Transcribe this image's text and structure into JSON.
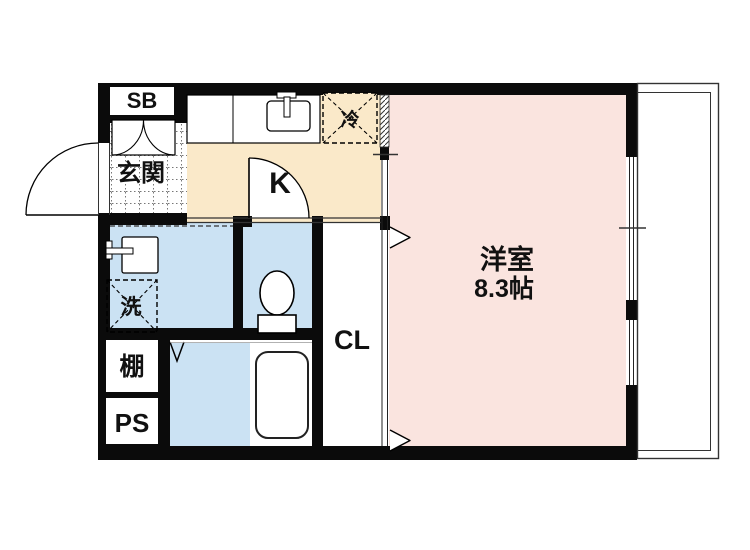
{
  "plan": {
    "labels": {
      "shoe_box": "SB",
      "entrance": "玄関",
      "kitchen": "K",
      "refrigerator": "冷",
      "washer": "洗",
      "shelf": "棚",
      "pipe_space": "PS",
      "closet": "CL",
      "room_name": "洋室",
      "room_size": "8.3帖"
    },
    "colors": {
      "wall": "#0b0b0b",
      "kitchen_floor": "#FAE9C9",
      "room_floor": "#FAE4DF",
      "wet_floor": "#CBE2F3",
      "line": "#222222"
    }
  }
}
